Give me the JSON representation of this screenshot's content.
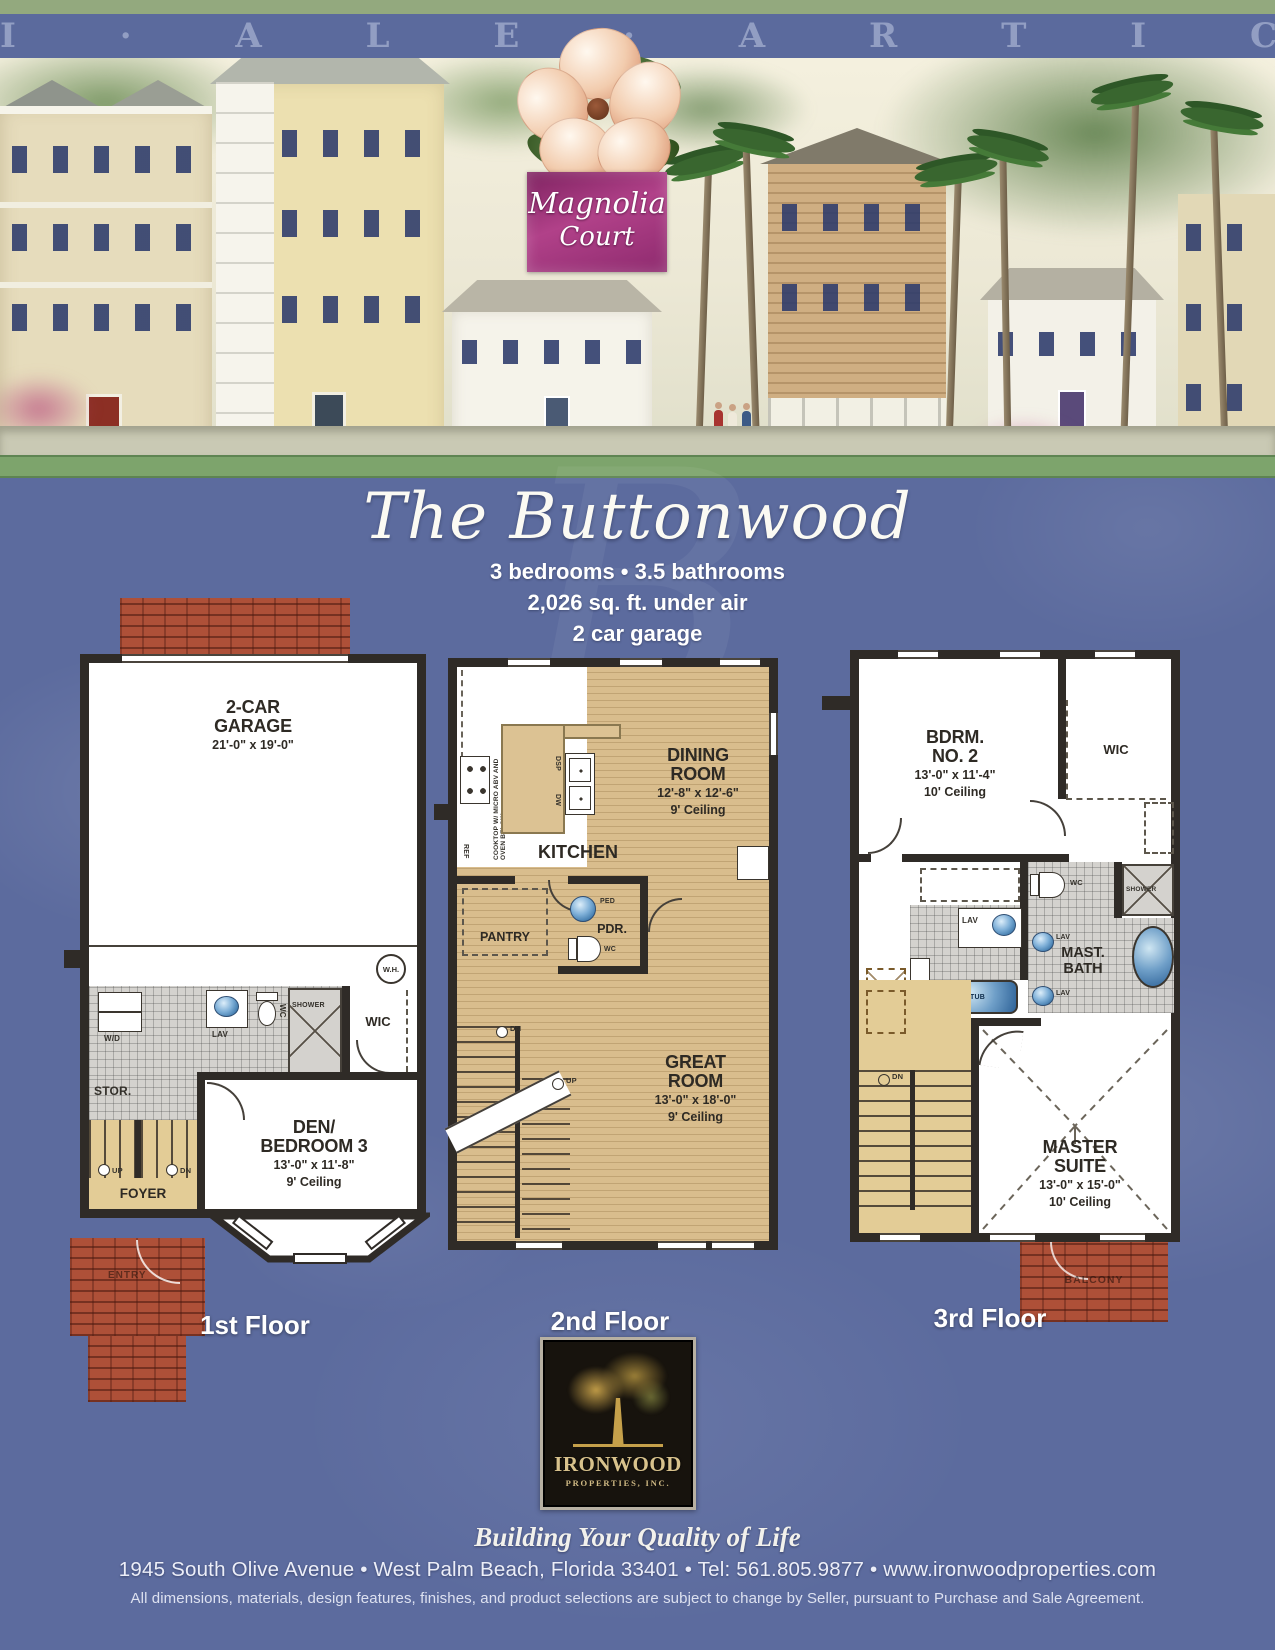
{
  "header": {
    "plat_letters": "I · A L E · A R T I C O",
    "community_line1": "Magnolia",
    "community_line2": "Court"
  },
  "title": {
    "name": "The Buttonwood",
    "watermark": "B",
    "spec1": "3 bedrooms • 3.5 bathrooms",
    "spec2": "2,026 sq. ft. under air",
    "spec3": "2 car garage"
  },
  "floor1": {
    "label": "1st Floor",
    "garage_name1": "2-CAR",
    "garage_name2": "GARAGE",
    "garage_dims": "21'-0\" x 19'-0\"",
    "wh": "W.H.",
    "wd": "W/D",
    "lav": "LAV",
    "wc": "WC",
    "shower": "SHOWER",
    "wic": "WIC",
    "stor": "STOR.",
    "up": "UP",
    "dn": "DN",
    "foyer": "FOYER",
    "entry": "ENTRY",
    "den_name1": "DEN/",
    "den_name2": "BEDROOM 3",
    "den_dims": "13'-0\" x 11'-8\"",
    "den_ceiling": "9' Ceiling"
  },
  "floor2": {
    "label": "2nd Floor",
    "kitchen": "KITCHEN",
    "cooktop_note": "COOKTOP W/ MICRO ABV AND OVEN BELOW",
    "dsp": "DSP",
    "dw": "DW",
    "ref": "REF",
    "dining_name1": "DINING",
    "dining_name2": "ROOM",
    "dining_dims": "12'-8\" x 12'-6\"",
    "dining_ceiling": "9' Ceiling",
    "pantry": "PANTRY",
    "ped": "PED",
    "pdr": "PDR.",
    "wc": "WC",
    "dn": "DN",
    "up": "UP",
    "great_name1": "GREAT",
    "great_name2": "ROOM",
    "great_dims": "13'-0\" x 18'-0\"",
    "great_ceiling": "9' Ceiling"
  },
  "floor3": {
    "label": "3rd Floor",
    "bdrm2_name1": "BDRM.",
    "bdrm2_name2": "NO. 2",
    "bdrm2_dims": "13'-0\" x 11'-4\"",
    "bdrm2_ceiling": "10' Ceiling",
    "wic": "WIC",
    "wc": "WC",
    "lav_a": "LAV",
    "lav_b": "LAV",
    "lav_c": "LAV",
    "tub": "TUB",
    "shower": "SHOWER",
    "mast_bath1": "MAST.",
    "mast_bath2": "BATH",
    "dn": "DN",
    "master_name1": "MASTER",
    "master_name2": "SUITE",
    "master_dims": "13'-0\" x 15'-0\"",
    "master_ceiling": "10' Ceiling",
    "balcony": "BALCONY"
  },
  "footer": {
    "logo_name": "IRONWOOD",
    "logo_sub": "PROPERTIES, INC.",
    "tagline": "Building Your Quality of Life",
    "address": "1945 South Olive Avenue • West Palm Beach, Florida 33401 • Tel: 561.805.9877 • www.ironwoodproperties.com",
    "disclaimer": "All dimensions, materials, design features, finishes, and product selections are subject to change by Seller, pursuant to Purchase and Sale Agreement."
  }
}
